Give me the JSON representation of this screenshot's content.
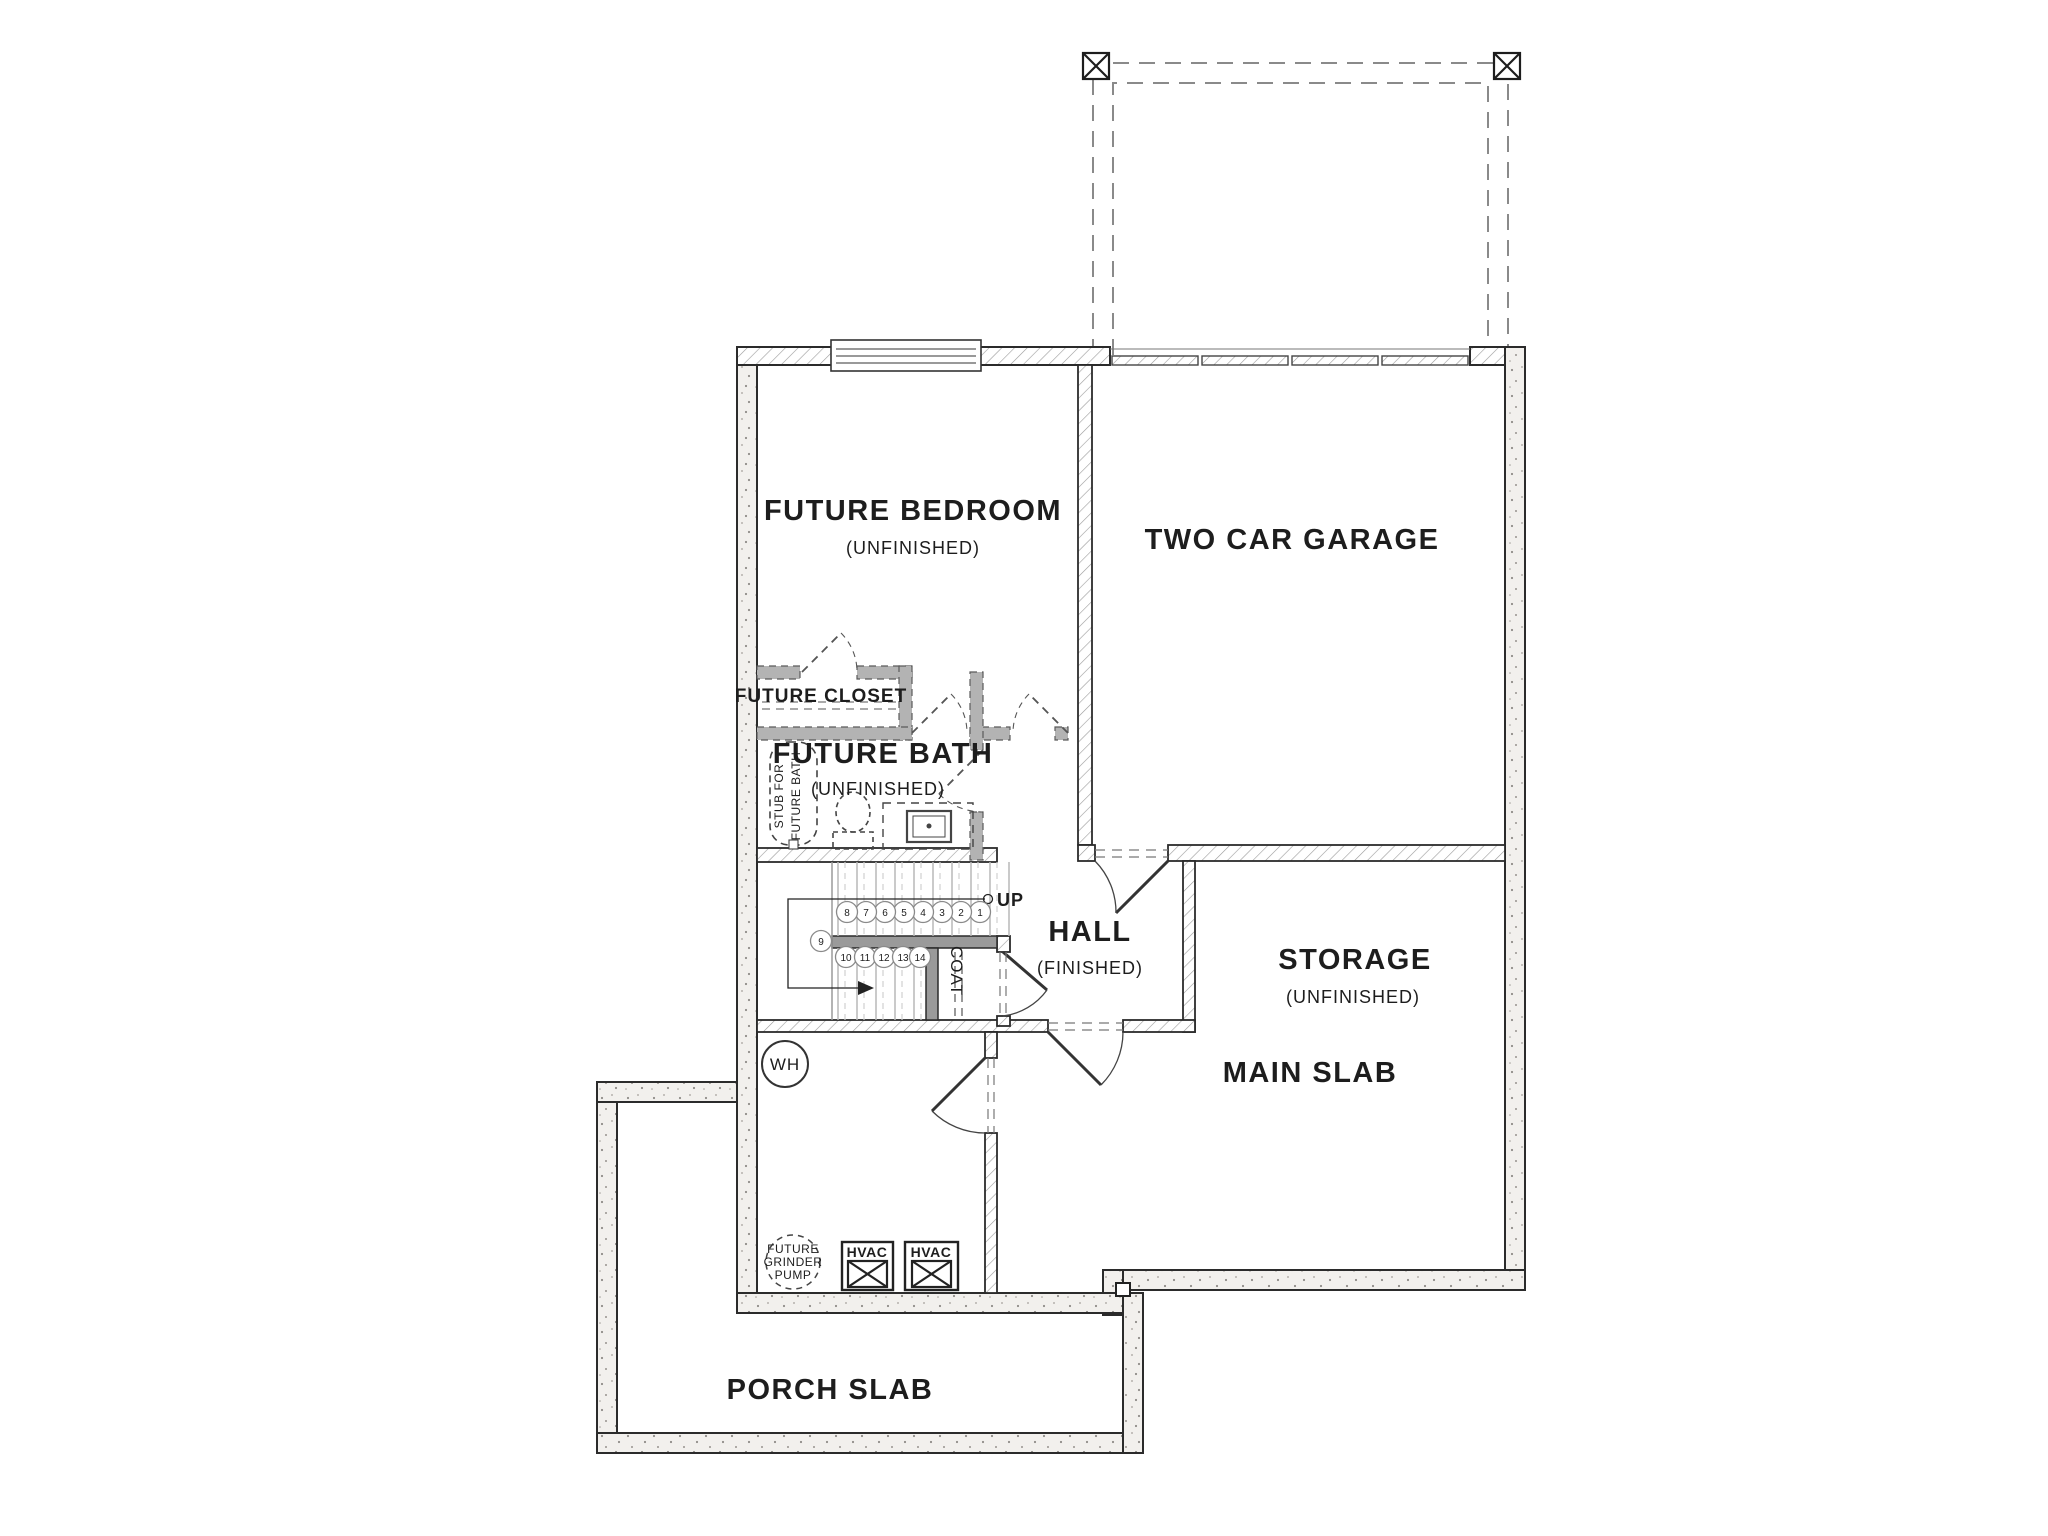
{
  "drawing": {
    "rooms": {
      "future_bedroom": {
        "name": "FUTURE BEDROOM",
        "status": "(UNFINISHED)"
      },
      "two_car_garage": {
        "name": "TWO CAR GARAGE"
      },
      "future_closet": {
        "name": "FUTURE CLOSET"
      },
      "future_bath": {
        "name": "FUTURE BATH",
        "status": "(UNFINISHED)"
      },
      "hall": {
        "name": "HALL",
        "status": "(FINISHED)"
      },
      "storage": {
        "name": "STORAGE",
        "status": "(UNFINISHED)"
      },
      "main_slab": {
        "name": "MAIN SLAB"
      },
      "porch_slab": {
        "name": "PORCH SLAB"
      },
      "coat_closet": {
        "name": "COAT"
      }
    },
    "stairs": {
      "direction_label": "UP",
      "tread_numbers": [
        "1",
        "2",
        "3",
        "4",
        "5",
        "6",
        "7",
        "8",
        "9",
        "10",
        "11",
        "12",
        "13",
        "14"
      ]
    },
    "fixtures": {
      "water_heater_label": "WH",
      "tub_stub_note": {
        "line1": "STUB FOR",
        "line2": "FUTURE BATH"
      },
      "grinder_pump": {
        "line1": "FUTURE",
        "line2": "GRINDER",
        "line3": "PUMP"
      },
      "hvac_units": [
        "HVAC",
        "HVAC"
      ]
    },
    "colors": {
      "line": "#2b2b2b",
      "concrete_fill": "#f2f0ed",
      "stipple_dot": "#8f8c88",
      "hatch_line": "#9b9b9b",
      "future_wall": "#b3b3b3",
      "stair_line": "#b9b9b9",
      "text": "#1d1d1d"
    }
  }
}
